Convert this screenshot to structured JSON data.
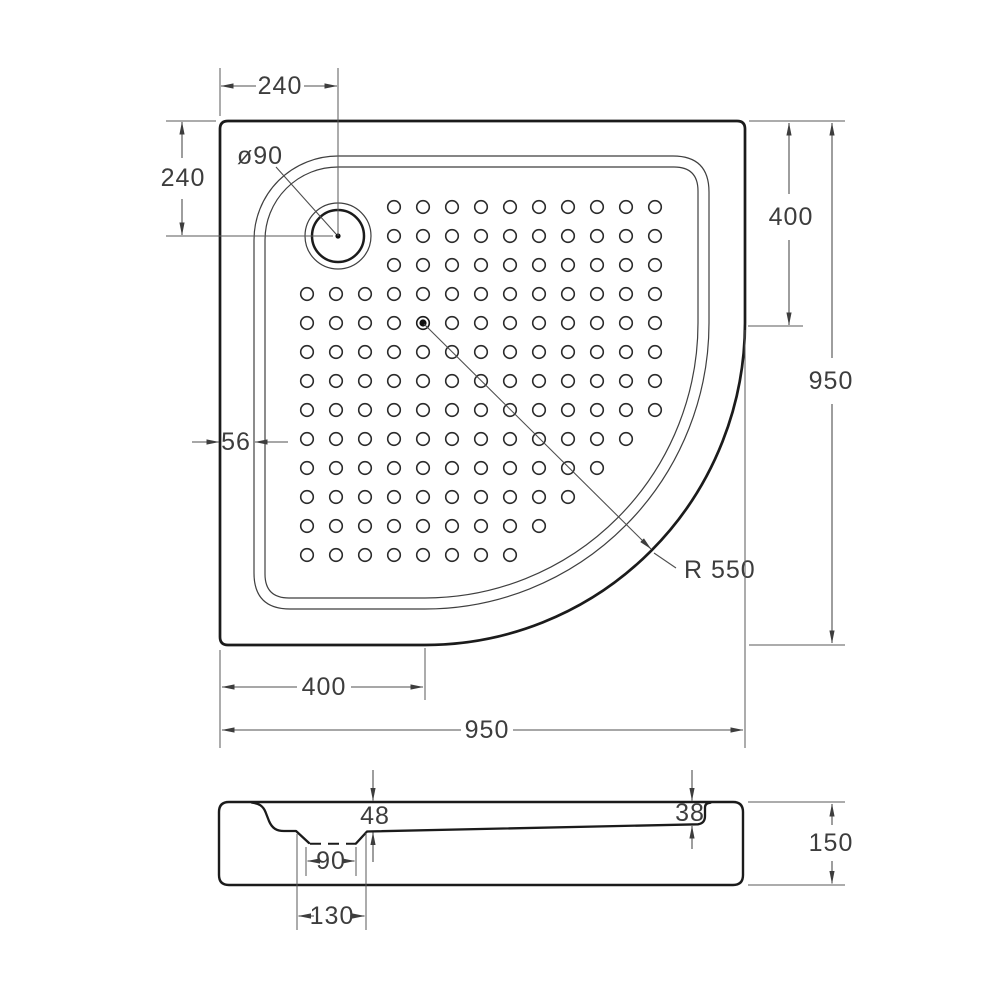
{
  "top_view": {
    "dims": {
      "top_width": "240",
      "left_height": "240",
      "drain_diameter": "ø90",
      "rim_width": "56",
      "right_depth": "400",
      "right_total": "950",
      "corner_radius": "R 550",
      "bottom_straight": "400",
      "bottom_total": "950"
    },
    "tread_dots": {
      "origin_x": 307,
      "origin_y": 207,
      "spacing_x": 29,
      "spacing_y": 29,
      "radius": 6.3,
      "rows": [
        {
          "from": 3,
          "to": 12
        },
        {
          "from": 3,
          "to": 12
        },
        {
          "from": 3,
          "to": 12
        },
        {
          "from": 0,
          "to": 12
        },
        {
          "from": 0,
          "to": 12
        },
        {
          "from": 0,
          "to": 12
        },
        {
          "from": 0,
          "to": 12
        },
        {
          "from": 0,
          "to": 12
        },
        {
          "from": 0,
          "to": 11
        },
        {
          "from": 0,
          "to": 10
        },
        {
          "from": 0,
          "to": 9
        },
        {
          "from": 0,
          "to": 8
        },
        {
          "from": 0,
          "to": 7
        }
      ],
      "filled": {
        "row": 4,
        "col": 4
      }
    }
  },
  "section_view": {
    "dims": {
      "drain_depth": "48",
      "edge_depth": "38",
      "total_height": "150",
      "recess_width": "90",
      "recess_offset": "130"
    }
  }
}
